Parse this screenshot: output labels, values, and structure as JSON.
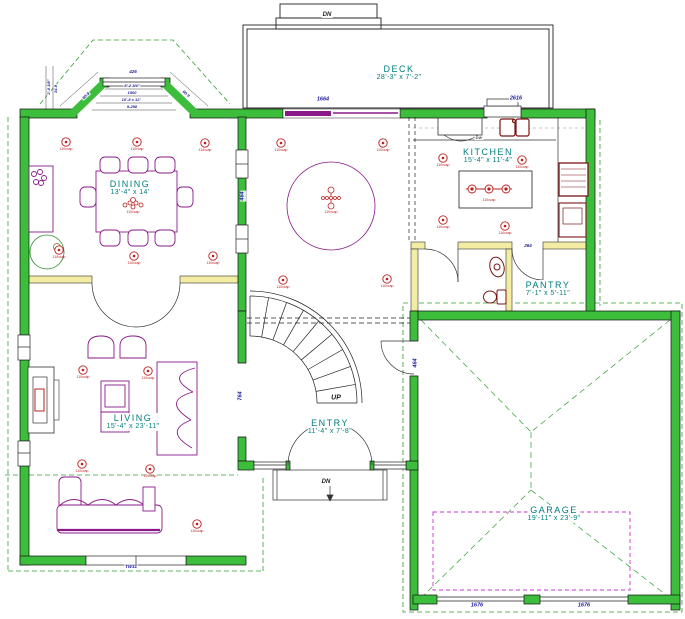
{
  "drawing": {
    "title": "first-floor-plan",
    "rooms": {
      "deck": {
        "name": "DECK",
        "dims": "28'-3\" x 7'-2\""
      },
      "kitchen": {
        "name": "KITCHEN",
        "dims": "15'-4\" x 11'-4\""
      },
      "dining": {
        "name": "DINING",
        "dims": "13'-4\" x 14'"
      },
      "living": {
        "name": "LIVING",
        "dims": "15'-4\" x 23'-11\""
      },
      "entry": {
        "name": "ENTRY",
        "dims": "11'-4\" x 7'-8\""
      },
      "pantry": {
        "name": "PANTRY",
        "dims": "7'-1\" x 5'-11\""
      },
      "garage": {
        "name": "GARAGE",
        "dims": "19'-11\" x 23'-9\""
      }
    },
    "annotations": [
      {
        "text": "1664",
        "x": 323,
        "y": 100
      },
      {
        "text": "2616",
        "x": 516,
        "y": 99
      },
      {
        "text": "426",
        "x": 133,
        "y": 72,
        "size": 4.5
      },
      {
        "text": "8'-2 3/4\"",
        "x": 132,
        "y": 86,
        "size": 4
      },
      {
        "text": "1500",
        "x": 132,
        "y": 93,
        "size": 4
      },
      {
        "text": "10'-8 x 12'",
        "x": 131,
        "y": 100,
        "size": 4
      },
      {
        "text": "9-298",
        "x": 132,
        "y": 107,
        "size": 4
      },
      {
        "text": "2'-0 3/8\"",
        "x": 49,
        "y": 87,
        "rot": -90,
        "size": 4
      },
      {
        "text": "34-9",
        "x": 56,
        "y": 89,
        "rot": -90,
        "size": 4
      },
      {
        "text": "60-9",
        "x": 86,
        "y": 96,
        "rot": -42,
        "size": 4
      },
      {
        "text": "60-9",
        "x": 186,
        "y": 94,
        "rot": 42,
        "size": 4
      },
      {
        "text": "464",
        "x": 243,
        "y": 196,
        "rot": -90
      },
      {
        "text": "764",
        "x": 241,
        "y": 396,
        "rot": -90
      },
      {
        "text": "464",
        "x": 416,
        "y": 363,
        "rot": -90
      },
      {
        "text": "264",
        "x": 528,
        "y": 246,
        "size": 4.5
      },
      {
        "text": "1676",
        "x": 477,
        "y": 606
      },
      {
        "text": "1676",
        "x": 584,
        "y": 606
      },
      {
        "text": "TW31",
        "x": 131,
        "y": 567,
        "size": 4.5
      },
      {
        "text": "UP",
        "x": 336,
        "y": 398,
        "color": "#222222",
        "size": 7
      },
      {
        "text": "DN",
        "x": 327,
        "y": 15,
        "color": "#222222",
        "size": 6
      },
      {
        "text": "DN",
        "x": 326,
        "y": 482,
        "color": "#222222",
        "size": 6
      },
      {
        "text": "DW",
        "x": 479,
        "y": 138,
        "color": "#555555",
        "size": 4
      }
    ],
    "fixture_label": "110vcap",
    "lights": [
      [
        66,
        142
      ],
      [
        137,
        142
      ],
      [
        205,
        143
      ],
      [
        59,
        250
      ],
      [
        134,
        256
      ],
      [
        213,
        256
      ],
      [
        281,
        143
      ],
      [
        383,
        143
      ],
      [
        443,
        158
      ],
      [
        522,
        160
      ],
      [
        443,
        220
      ],
      [
        505,
        226
      ],
      [
        283,
        280
      ],
      [
        387,
        279
      ],
      [
        83,
        370
      ],
      [
        148,
        371
      ],
      [
        82,
        464
      ],
      [
        150,
        469
      ],
      [
        197,
        524
      ]
    ],
    "colors": {
      "exterior_wall": "#3cbd3c",
      "interior_wall": "#f2eda2",
      "room_label": "#007d7d",
      "dim_label": "#1b1b9e",
      "furniture": "#8a1a8a",
      "fixture": "#bb2020",
      "eave": "#2f9f2f",
      "attic": "#cc33cc"
    }
  }
}
